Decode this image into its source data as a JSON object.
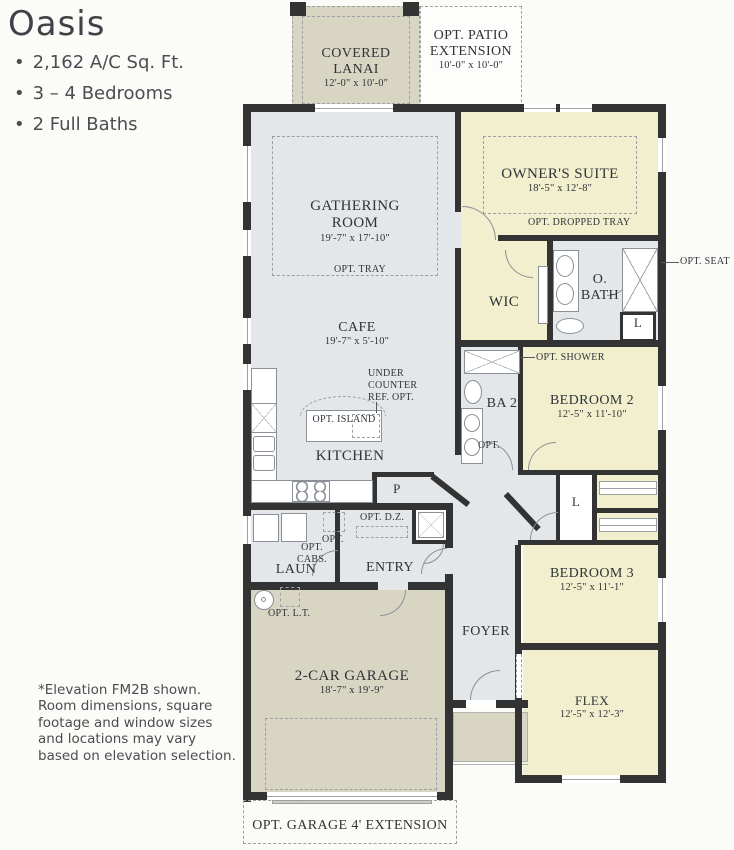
{
  "info": {
    "title": "Oasis",
    "bullets": [
      "2,162 A/C Sq. Ft.",
      "3 – 4 Bedrooms",
      "2 Full Baths"
    ],
    "footnote": "*Elevation FM2B shown. Room dimensions, square footage and window sizes and locations may vary based on elevation selection."
  },
  "colors": {
    "wall": "#333333",
    "living": "#e4e7e9",
    "bedroom": "#f1efce",
    "garage": "#d8d5c3"
  },
  "rooms": {
    "lanai": {
      "name": "COVERED LANAI",
      "dims": "12'-0\" x 10'-0\""
    },
    "patio": {
      "name": "OPT. PATIO EXTENSION",
      "dims": "10'-0\" x 10'-0\""
    },
    "gathering": {
      "name": "GATHERING ROOM",
      "dims": "19'-7\" x 17'-10\"",
      "opt": "OPT. TRAY"
    },
    "owners": {
      "name": "OWNER'S SUITE",
      "dims": "18'-5\" x 12'-8\"",
      "opt": "OPT. DROPPED TRAY"
    },
    "wic": {
      "name": "WIC"
    },
    "obath": {
      "name": "O. BATH",
      "linen": "L"
    },
    "cafe": {
      "name": "CAFE",
      "dims": "19'-7\" x 5'-10\""
    },
    "kitchen": {
      "name": "KITCHEN"
    },
    "ba2": {
      "name": "BA 2",
      "opt": "OPT."
    },
    "bed2": {
      "name": "BEDROOM 2",
      "dims": "12'-5\" x 11'-10\""
    },
    "bed3": {
      "name": "BEDROOM 3",
      "dims": "12'-5\" x 11'-1\""
    },
    "flex": {
      "name": "FLEX",
      "dims": "12'-5\" x 12'-3\""
    },
    "laun": {
      "name": "LAUN"
    },
    "entry": {
      "name": "ENTRY"
    },
    "foyer": {
      "name": "FOYER"
    },
    "pantry": {
      "name": "P"
    },
    "linen": {
      "name": "L"
    },
    "garage": {
      "name": "2-CAR GARAGE",
      "dims": "18'-7\" x 19'-9\""
    }
  },
  "annotations": {
    "opt_seat": "OPT. SEAT",
    "opt_shower": "OPT. SHOWER",
    "under_counter_ref": "UNDER COUNTER REF. OPT.",
    "opt_island": "OPT. ISLAND",
    "opt_dz": "OPT. D.Z.",
    "opt_cabs": "OPT. CABS.",
    "opt_appliance": "OPT.",
    "opt_lt": "OPT. L.T.",
    "garage_extension": "OPT. GARAGE 4' EXTENSION"
  }
}
